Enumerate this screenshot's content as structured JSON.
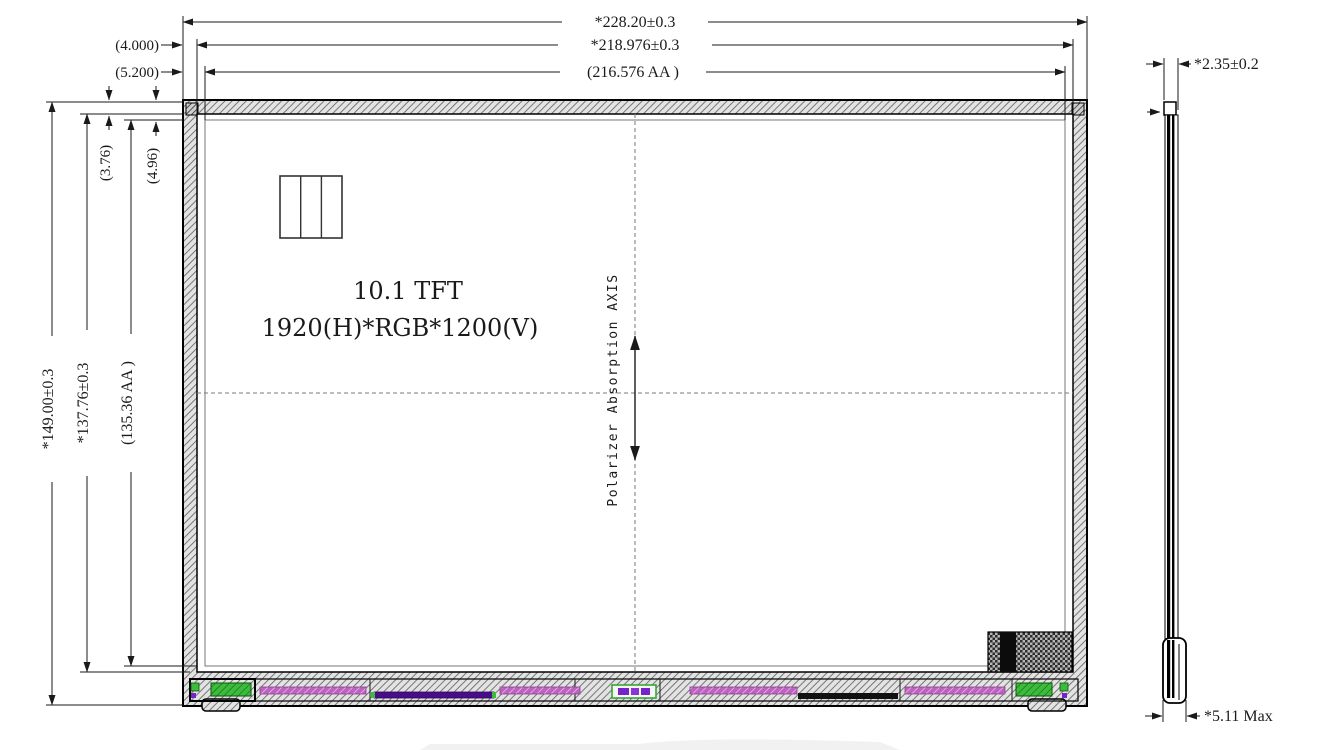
{
  "drawing": {
    "front_view": {
      "title_line1": "10.1 TFT",
      "title_line2": "1920(H)*RGB*1200(V)",
      "polarizer_label": "Polarizer Absorption AXIS"
    },
    "dimensions": {
      "width_outline": "*228.20±0.3",
      "width_glass": "*218.976±0.3",
      "width_active": "(216.576 AA )",
      "height_outline": "*149.00±0.3",
      "height_glass": "*137.76±0.3",
      "height_active": "(135.36 AA )",
      "gap_left_glass": "(4.000)",
      "gap_left_active": "(5.200)",
      "gap_top_glass": "(3.76)",
      "gap_top_active": "(4.96)",
      "thickness_panel": "*2.35±0.2",
      "thickness_max": "*5.11 Max"
    },
    "colors": {
      "component_green": "#3dbb3d",
      "component_magenta": "#bd62c1",
      "component_purple": "#4a0d8a",
      "component_black": "#111111"
    }
  }
}
